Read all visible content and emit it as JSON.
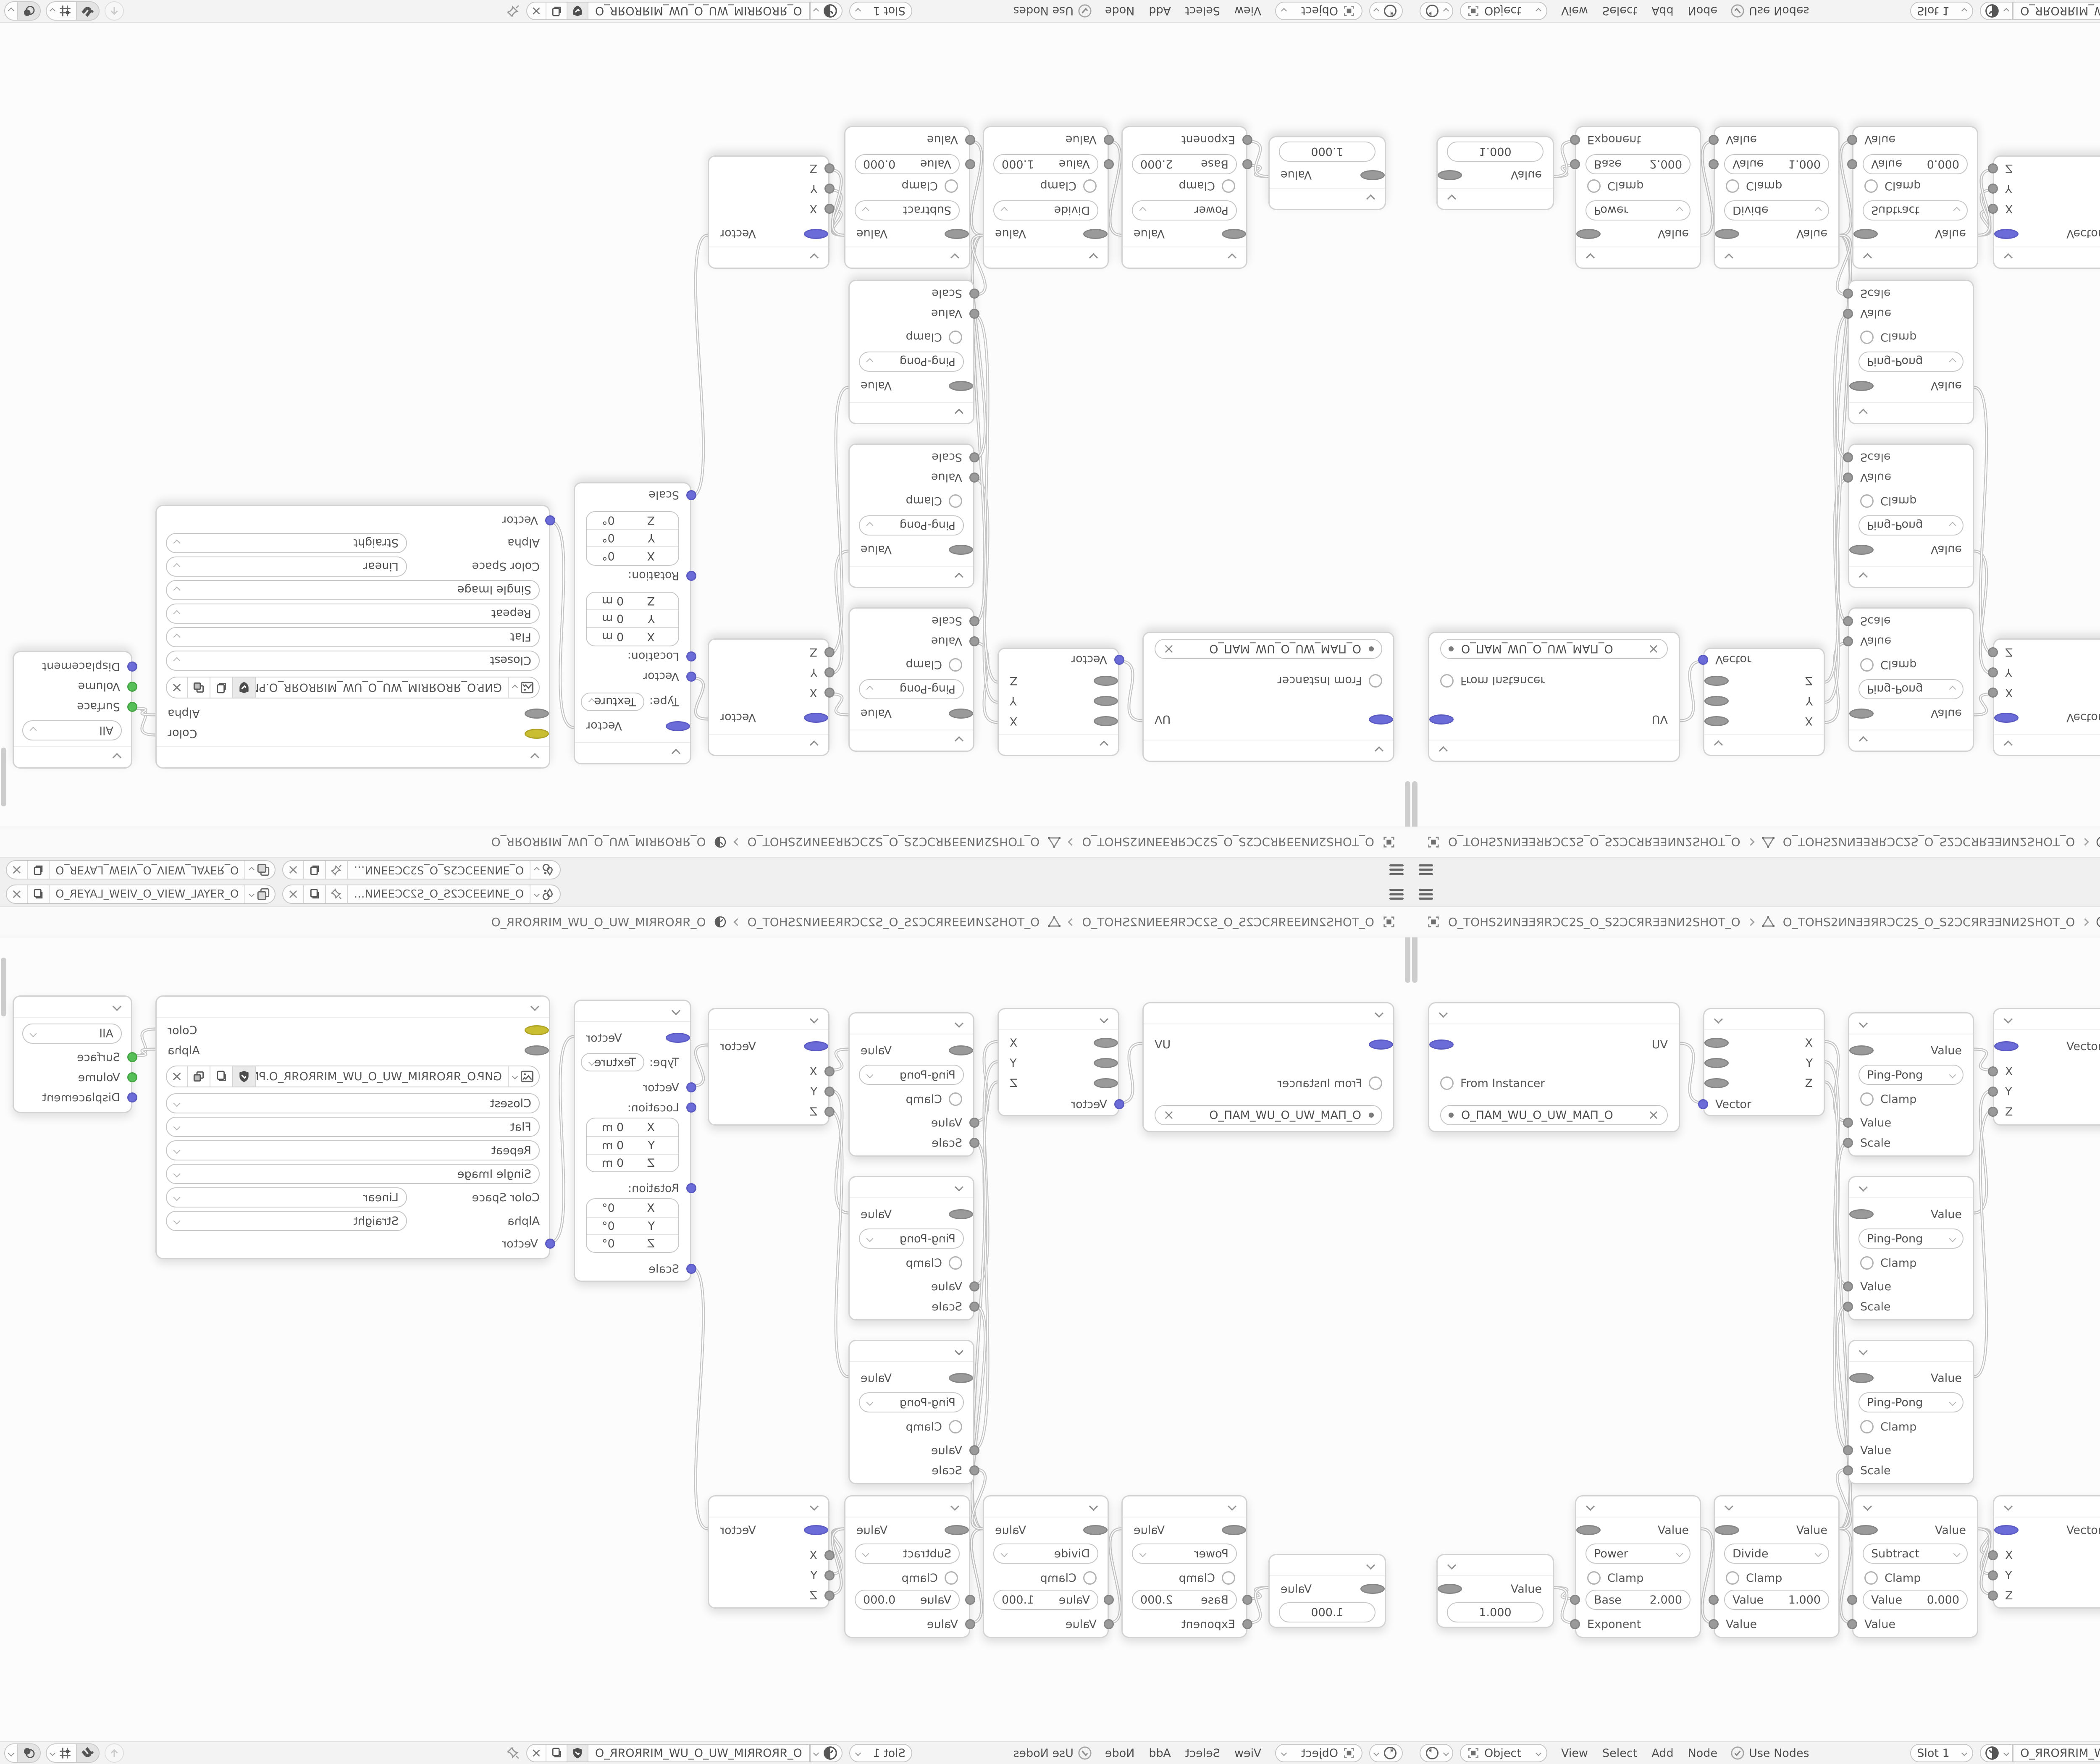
{
  "window": {
    "topbar": {
      "scene": "O_ƎИΝƎƎƆC2S_O_S2ƆCƎƎΝИ…",
      "view_layer": "O_ЯƎYAL_WƎIV_O_VIƎW_LAYƎR_O"
    },
    "breadcrumb": {
      "object": "O_TOHS2ИΝƎƎЯRƆC2S_O_S2ƆCЯRƎƎΝИ2SHOT_O",
      "mesh": "O_TOHS2ИΝƎƎЯRƆC2S_O_S2ƆCЯRƎƎΝИ2SHOT_O",
      "material": "O_ЯROЯRIM_WU_O_UW_MIЯROЯR_O"
    },
    "header": {
      "mode": "Object",
      "menus": [
        "View",
        "Select",
        "Add",
        "Node"
      ],
      "use_nodes": "Use Nodes",
      "slot": "Slot 1",
      "material": "O_ЯROЯRIM_WU_O_UW_MIЯROЯR_O"
    }
  },
  "nodes": {
    "uv_map": {
      "out": "UV",
      "from_instancer": "From Instancer",
      "uv_name": "O_ПAM_WU_O_UW_MAП_O"
    },
    "separate_xyz": {
      "x": "X",
      "y": "Y",
      "z": "Z",
      "vector": "Vector"
    },
    "pingpong": {
      "out": "Value",
      "op": "Ping-Pong",
      "clamp": "Clamp",
      "value": "Value",
      "scale": "Scale"
    },
    "combine_xyz": {
      "out": "Vector",
      "x": "X",
      "y": "Y",
      "z": "Z"
    },
    "mapping": {
      "out": "Vector",
      "type_label": "Type:",
      "type": "Texture",
      "vector": "Vector",
      "location": "Location:",
      "rotation": "Rotation:",
      "scale": "Scale",
      "loc": [
        {
          "k": "X",
          "v": "0 m"
        },
        {
          "k": "Y",
          "v": "0 m"
        },
        {
          "k": "Z",
          "v": "0 m"
        }
      ],
      "rot": [
        {
          "k": "X",
          "v": "0°"
        },
        {
          "k": "Y",
          "v": "0°"
        },
        {
          "k": "Z",
          "v": "0°"
        }
      ]
    },
    "image_texture": {
      "color": "Color",
      "alpha": "Alpha",
      "filename": "GИP.O_ЯROЯRIM_WU_O_UW_MIЯROЯR_O.PNG",
      "interpolation": "Closest",
      "projection": "Flat",
      "extension": "Repeat",
      "source": "Single Image",
      "color_space_label": "Color Space",
      "color_space": "Linear",
      "alpha_label": "Alpha",
      "alpha_mode": "Straight",
      "vector": "Vector"
    },
    "output": {
      "target": "All",
      "surface": "Surface",
      "volume": "Volume",
      "displacement": "Displacement"
    },
    "value": {
      "out": "Value",
      "value": "1.000"
    },
    "power": {
      "out": "Value",
      "op": "Power",
      "clamp": "Clamp",
      "base_label": "Base",
      "base": "2.000",
      "exponent": "Exponent"
    },
    "divide": {
      "out": "Value",
      "op": "Divide",
      "clamp": "Clamp",
      "value_label": "Value",
      "value": "1.000",
      "value_in": "Value"
    },
    "subtract": {
      "out": "Value",
      "op": "Subtract",
      "clamp": "Clamp",
      "value_label": "Value",
      "value": "0.000",
      "value_in": "Value"
    }
  },
  "colors": {
    "vector_socket": "#6c6cd9",
    "color_socket": "#c9bd32",
    "shader_socket": "#57bf57",
    "value_socket": "#9a9a9a",
    "wire": "#c6c6c6"
  }
}
